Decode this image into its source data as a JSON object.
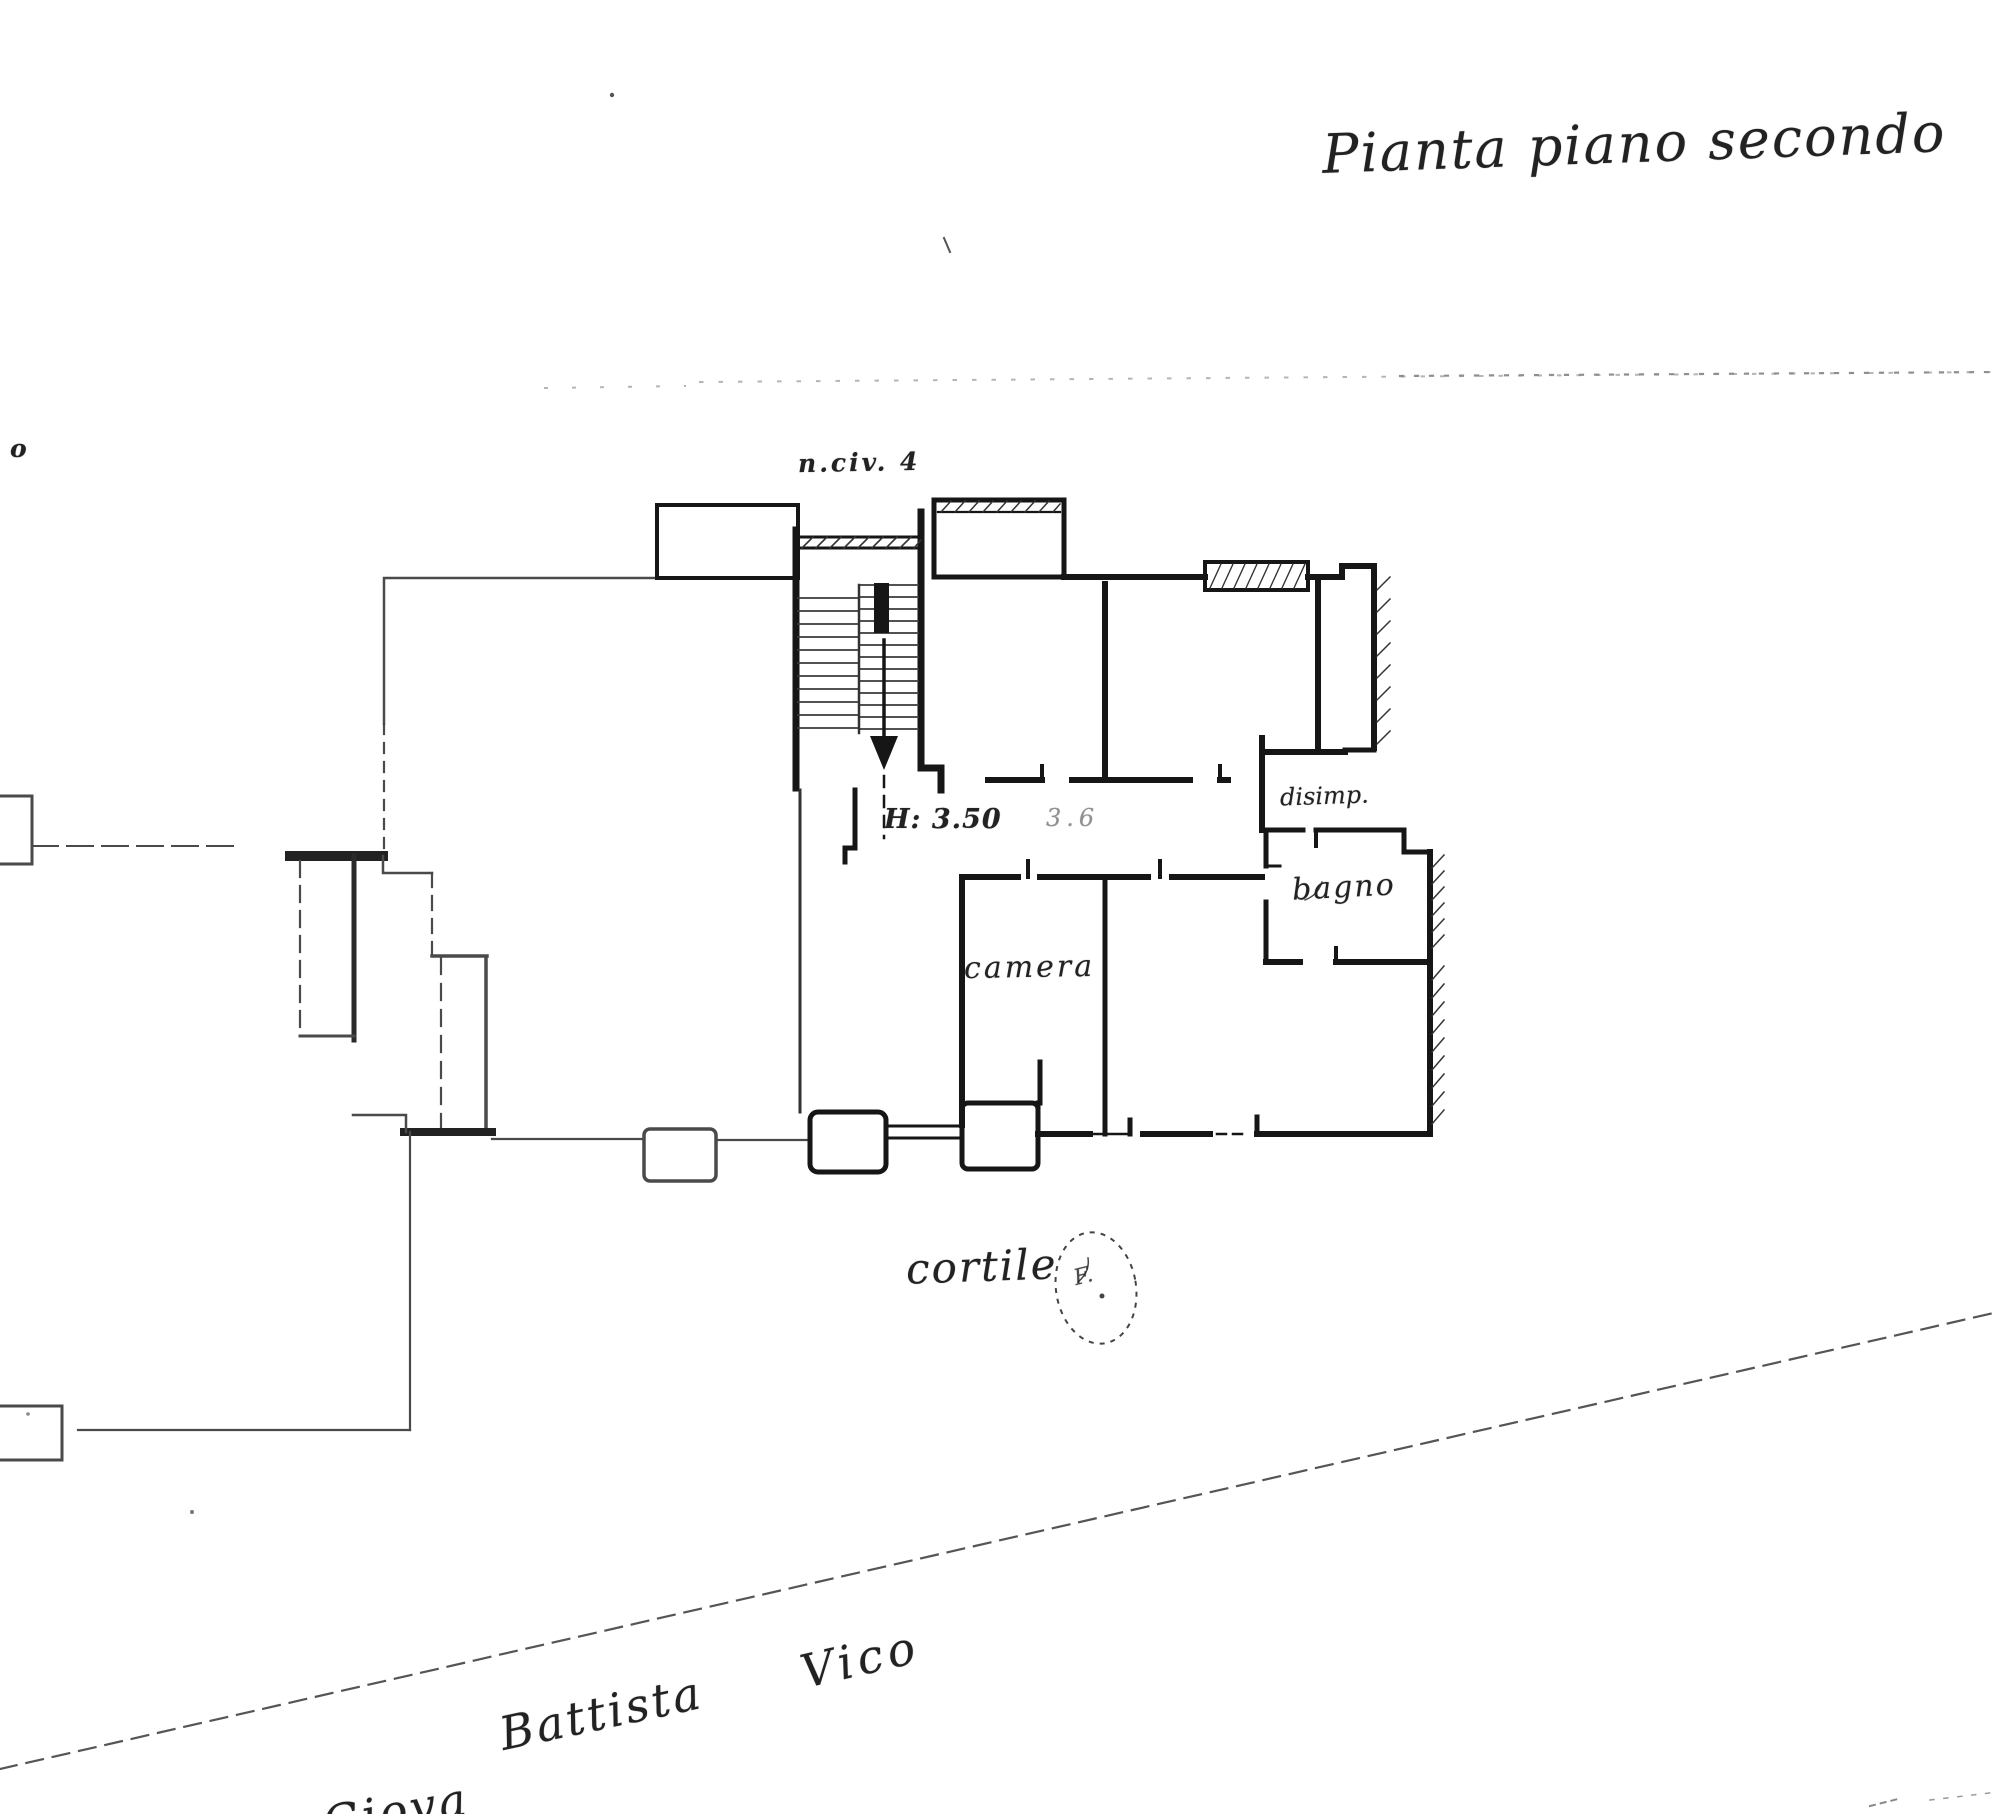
{
  "title": "Pianta piano secondo",
  "plan": {
    "stair_label": "n.civ. 4",
    "height_note": "H: 3.50",
    "small_note": "3.6",
    "rooms": {
      "camera": "camera",
      "disimpegno": "disimp.",
      "bagno": "bagno"
    },
    "courtyard": {
      "label": "cortile",
      "mark": "F."
    }
  },
  "street": {
    "name_part1": "Battista",
    "name_part2": "Vico",
    "partial_word": "Giova"
  },
  "fragments": {
    "left_edge": "o"
  },
  "icons": {
    "stairs_down_arrow": "↓"
  },
  "colors": {
    "ink": "#1a1a1a",
    "wall": "#161616",
    "thin_line": "#4a4a4a",
    "faint_dots": "#b5b5b5",
    "paper": "#ffffff"
  }
}
